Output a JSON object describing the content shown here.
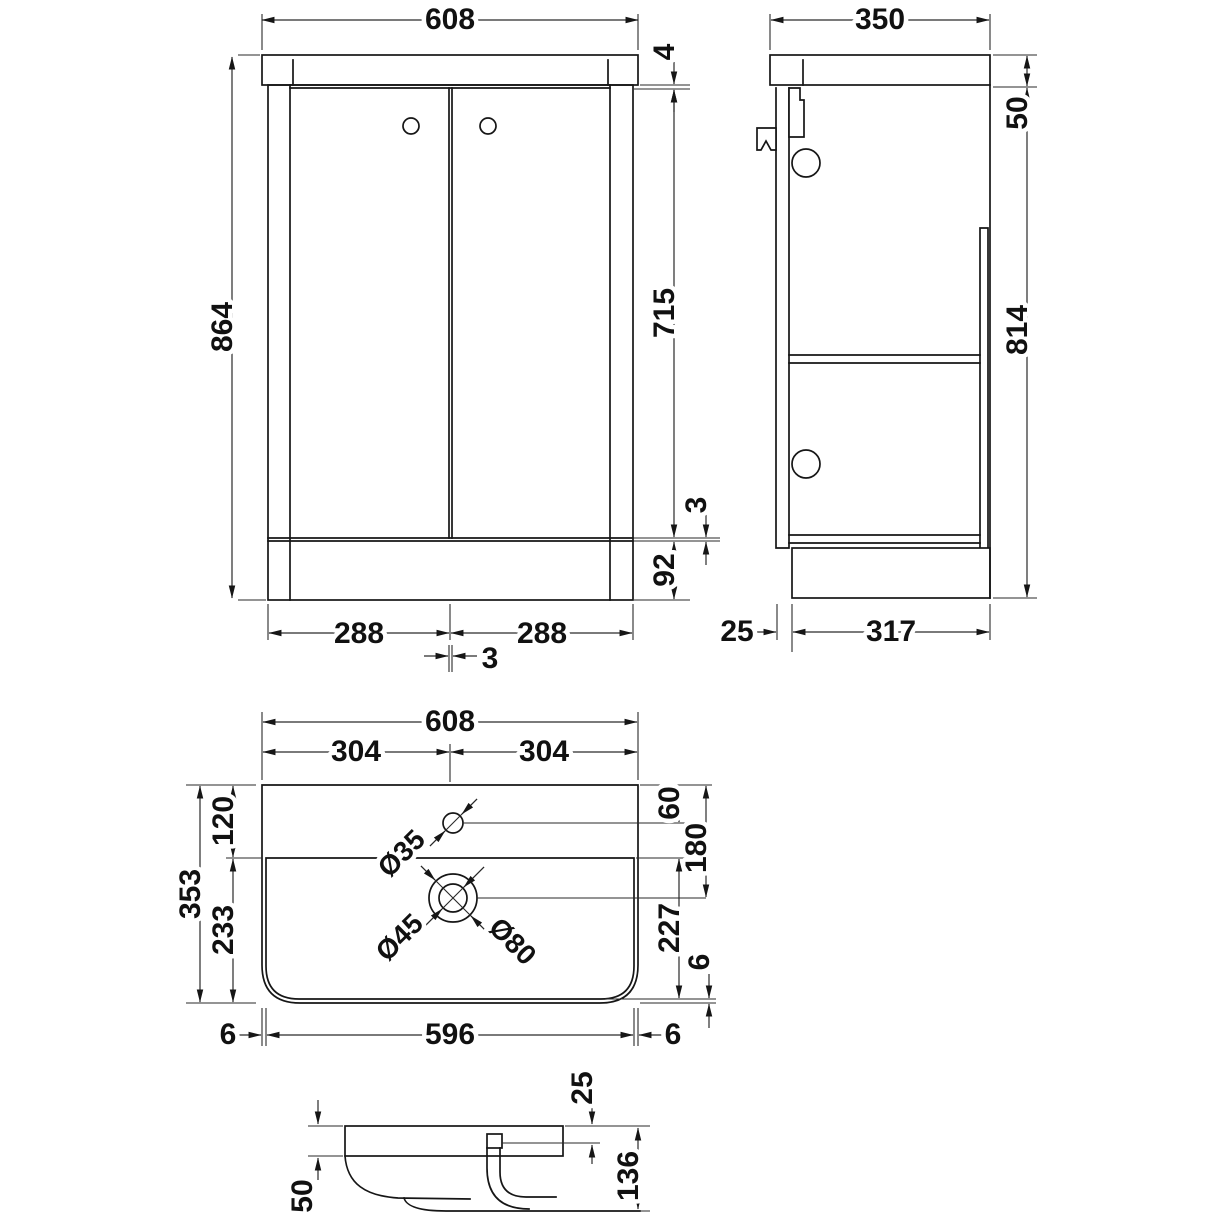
{
  "meta": {
    "type": "technical-drawing",
    "subject": "bathroom vanity unit with basin - dimensioned views",
    "units": "mm",
    "line_color": "#161616",
    "background_color": "#ffffff"
  },
  "front": {
    "overall_width": "608",
    "overall_height": "864",
    "worktop_lip": "4",
    "door_height": "715",
    "door_bottom_gap": "3",
    "plinth_height": "92",
    "left_door_width": "288",
    "right_door_width": "288",
    "door_center_gap": "3"
  },
  "side": {
    "overall_depth": "350",
    "worktop_height": "50",
    "carcass_height": "814",
    "door_thickness": "25",
    "plinth_depth": "317"
  },
  "plan": {
    "overall_width": "608",
    "left_half": "304",
    "right_half": "304",
    "back_to_basin": "120",
    "basin_to_front": "233",
    "overall_depth": "353",
    "back_to_tap": "60",
    "back_to_waste": "180",
    "basin_inner_depth": "227",
    "front_rim": "6",
    "left_rim": "6",
    "basin_inner_width": "596",
    "right_rim": "6",
    "tap_hole_dia": "Ø35",
    "waste_hole_dia": "Ø45",
    "waste_recess_dia": "Ø80"
  },
  "section": {
    "rim_height": "50",
    "deck_thickness": "25",
    "basin_depth": "136"
  }
}
